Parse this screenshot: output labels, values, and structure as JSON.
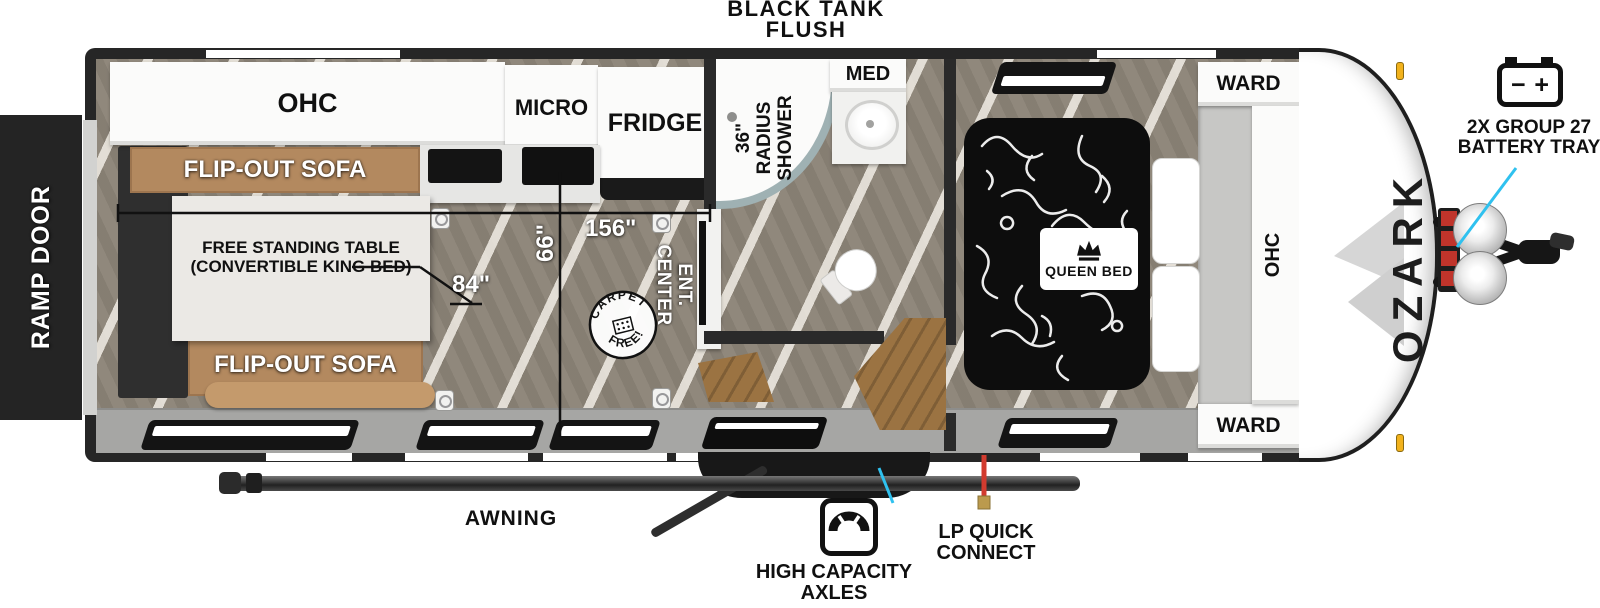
{
  "callouts": {
    "black_tank_flush": "BLACK  TANK\nFLUSH",
    "battery_tray": "2X GROUP 27\nBATTERY TRAY",
    "awning": "AWNING",
    "high_capacity_axles": "HIGH CAPACITY\nAXLES",
    "lp_quick_connect": "LP QUICK\nCONNECT",
    "ramp_door": "RAMP DOOR"
  },
  "battery_symbol": {
    "minus": "−",
    "plus": "+"
  },
  "brand": {
    "name": "OZARK"
  },
  "rooms": {
    "kitchen": {
      "ohc": "OHC",
      "micro": "MICRO",
      "fridge": "FRIDGE"
    },
    "living": {
      "sofa_top": "FLIP-OUT SOFA",
      "sofa_bottom": "FLIP-OUT SOFA",
      "table": "FREE STANDING TABLE\n(CONVERTIBLE KING BED)",
      "ent_center": "ENT.\nCENTER",
      "carpet_free_top": "CARPET",
      "carpet_free_bottom": "FREE!"
    },
    "bath": {
      "shower": "36\"\nRADIUS\nSHOWER",
      "med": "MED"
    },
    "bedroom": {
      "queen_bed": "QUEEN BED",
      "ward_top": "WARD",
      "ward_bottom": "WARD",
      "ohc": "OHC"
    }
  },
  "dimensions": {
    "main_width": "156\"",
    "interior_width": "66\"",
    "table_length": "84\""
  },
  "colors": {
    "accent_cyan": "#2fc1ef",
    "lp_red": "#d23b2f",
    "sofa_tan": "#b3895f",
    "wall_dark": "#262626",
    "amber_marker": "#f2b21c"
  }
}
